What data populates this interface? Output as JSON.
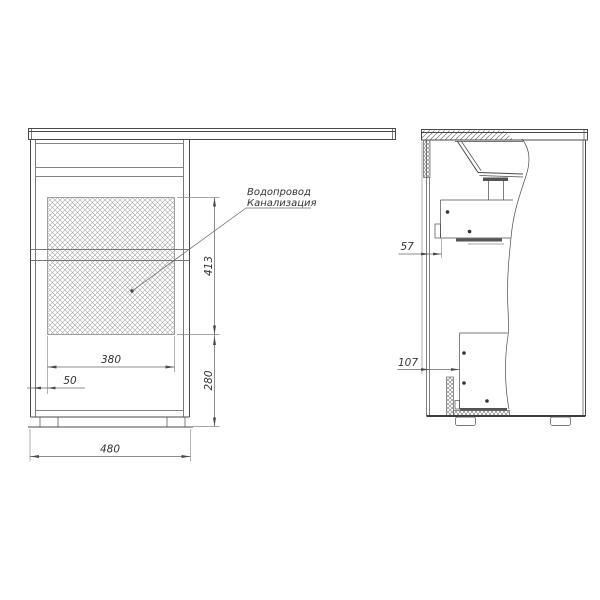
{
  "drawing": {
    "annotation": {
      "line1": "Водопровод",
      "line2": "Канализация"
    },
    "front_view": {
      "dim_hatch_height": "413",
      "dim_bottom_height": "280",
      "dim_hatch_width": "380",
      "dim_left_offset": "50",
      "dim_total_width": "480"
    },
    "side_view": {
      "dim_top_clearance": "57",
      "dim_bottom_clearance": "107"
    }
  }
}
